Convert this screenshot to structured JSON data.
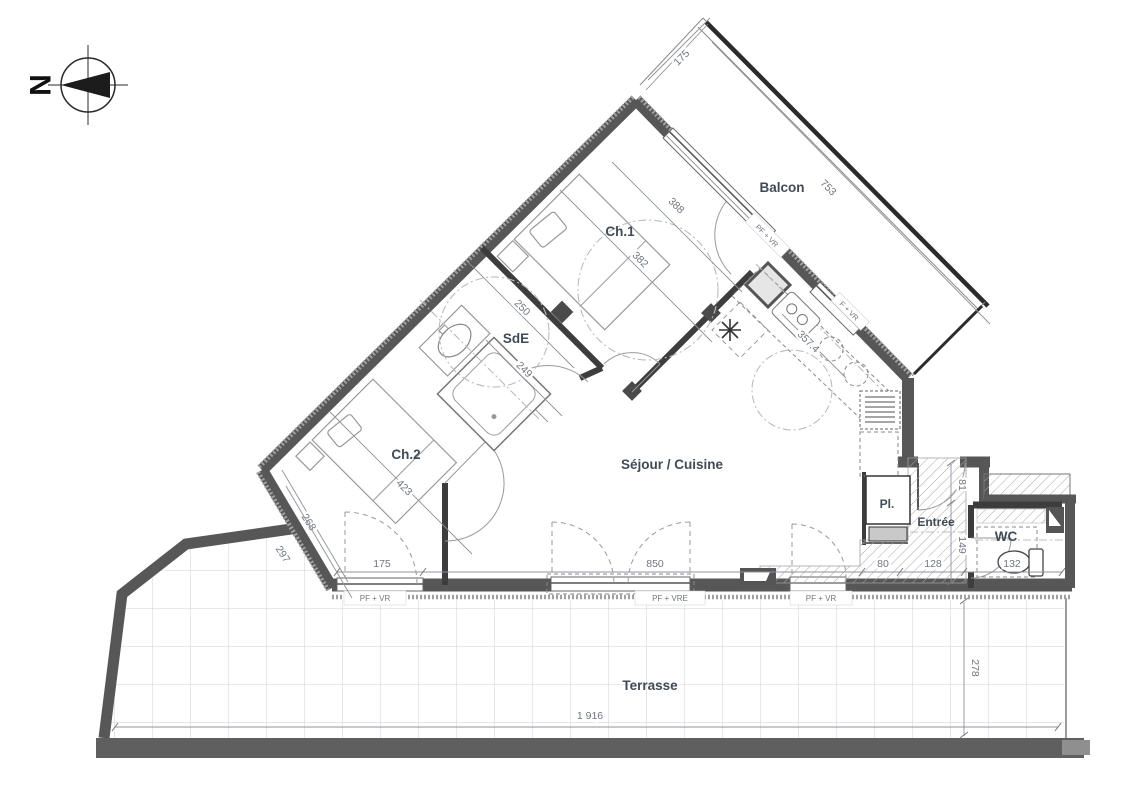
{
  "compass": {
    "north": "N"
  },
  "rooms": {
    "balcon": "Balcon",
    "ch1": "Ch.1",
    "sde": "SdE",
    "ch2": "Ch.2",
    "sejour": "Séjour / Cuisine",
    "pl": "Pl.",
    "entree": "Entrée",
    "wc": "WC",
    "terrasse": "Terrasse"
  },
  "dims": {
    "balcon_width": "175",
    "balcon_length": "753",
    "ch1_a": "388",
    "ch1_b": "382",
    "sde_a": "250",
    "sde_b": "249",
    "ch2_a": "423",
    "ch2_b": "268",
    "terrace_edge": "297",
    "kitchen_run": "357.4",
    "win_ch2": "175",
    "win_sejour": "850",
    "pl_w": "80",
    "entree_w": "128",
    "wc_w": "132",
    "entree_h_a": "81",
    "entree_h_b": "149",
    "terrasse_depth": "278",
    "terrasse_length": "1 916"
  },
  "windows": {
    "pf_vr": "PF + VR",
    "f_vr": "F + VR",
    "pf_vre": "PF + VRE"
  },
  "colors": {
    "wall": "#575757",
    "partition": "#3d3d3d",
    "label": "#414b57",
    "dim_text": "#6f7680",
    "grid": "#d2d2d2"
  }
}
